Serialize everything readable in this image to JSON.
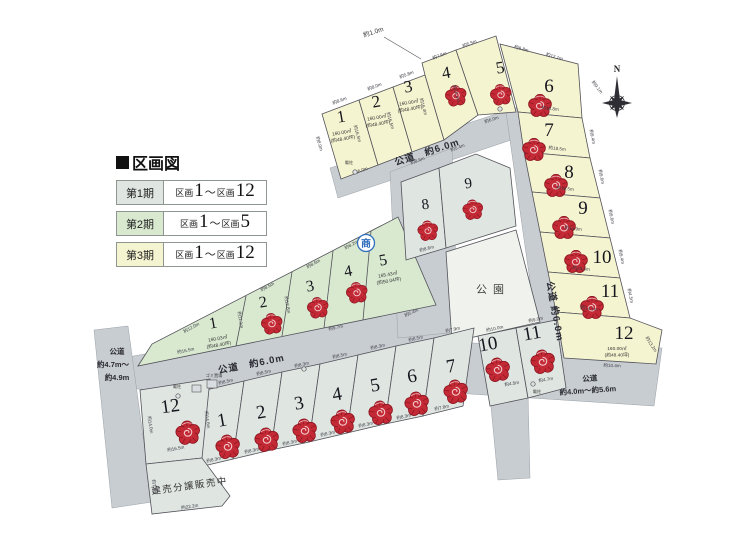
{
  "colors": {
    "phase1": "#dfe5e1",
    "phase2": "#d9e9d0",
    "phase3": "#f5f4d0",
    "road": "#c8cdd1",
    "park": "#f0f3ed",
    "stroke": "#52525a",
    "rose": "#c42a35",
    "roseDark": "#8e1722",
    "roseLight": "#f3cdd0",
    "accent": "#2f6fbe"
  },
  "legend": {
    "title": "区画図",
    "rows": [
      {
        "phase": "第1期",
        "prefix": "区画",
        "from": "1",
        "tilde": "～",
        "prefix2": "区画",
        "to": "12"
      },
      {
        "phase": "第2期",
        "prefix": "区画",
        "from": "1",
        "tilde": "～",
        "prefix2": "区画",
        "to": "5"
      },
      {
        "phase": "第3期",
        "prefix": "区画",
        "from": "1",
        "tilde": "～",
        "prefix2": "区画",
        "to": "12"
      }
    ]
  },
  "map": {
    "compass_label": "N",
    "sho_mark": "商",
    "park_label": "公園",
    "built_sale_label": "建売分譲販売中",
    "top_gap_label": "約1.0m",
    "markers": {
      "denchu": "電柱",
      "gomi": "ゴミ置場"
    },
    "road_labels": {
      "top": "公道　約6.0m",
      "right": "公道 約6.0m",
      "middle": "公道　約6.0m",
      "br_road": "公道",
      "br_width": "約4.0m～約5.6m",
      "left_road": "公道",
      "left_w1": "約4.7m～",
      "left_w2": "約4.9m"
    },
    "lot_groups": [
      {
        "phase": "第3期",
        "fs": 17,
        "rot": -10,
        "rose_size": 22,
        "lots": [
          {
            "n": "1",
            "x": 342,
            "y": 122,
            "area": [
              "160.00㎡",
              "(約48.40坪)"
            ],
            "ax": 342,
            "ay": 134
          },
          {
            "n": "2",
            "x": 377,
            "y": 107,
            "area": [
              "160.00㎡",
              "(約48.40坪)"
            ],
            "ax": 377,
            "ay": 119
          },
          {
            "n": "3",
            "x": 409,
            "y": 92,
            "area": [
              "160.00㎡",
              "(約48.40坪)"
            ],
            "ax": 409,
            "ay": 104
          },
          {
            "n": "4",
            "x": 447,
            "y": 78,
            "rx": 456,
            "ry": 96
          },
          {
            "n": "5",
            "x": 501,
            "y": 73,
            "rx": 501,
            "ry": 95
          }
        ]
      },
      {
        "phase": "第3期",
        "fs": 19,
        "rot": 0,
        "rose_size": 24,
        "lots": [
          {
            "n": "6",
            "x": 549,
            "y": 92,
            "rx": 540,
            "ry": 106
          },
          {
            "n": "7",
            "x": 549,
            "y": 136,
            "rx": 534,
            "ry": 150
          },
          {
            "n": "8",
            "x": 569,
            "y": 178,
            "rx": 556,
            "ry": 186
          },
          {
            "n": "9",
            "x": 583,
            "y": 214,
            "rx": 564,
            "ry": 228
          },
          {
            "n": "10",
            "x": 602,
            "y": 263,
            "rx": 576,
            "ry": 262
          },
          {
            "n": "11",
            "x": 610,
            "y": 297,
            "rx": 592,
            "ry": 308
          },
          {
            "n": "12",
            "x": 624,
            "y": 339,
            "area": [
              "160.00㎡",
              "(約48.40坪)"
            ],
            "ax": 617,
            "ay": 350
          }
        ]
      },
      {
        "phase": "第2期",
        "fs": 16,
        "rot": -10,
        "rose_size": 22,
        "lots": [
          {
            "n": "1",
            "x": 214,
            "y": 328,
            "area": [
              "160.03㎡",
              "(約48.40坪)"
            ],
            "ax": 218,
            "ay": 340
          },
          {
            "n": "2",
            "x": 264,
            "y": 307,
            "rx": 272,
            "ry": 324
          },
          {
            "n": "3",
            "x": 311,
            "y": 291,
            "rx": 318,
            "ry": 308
          },
          {
            "n": "4",
            "x": 349,
            "y": 276,
            "rx": 357,
            "ry": 293
          },
          {
            "n": "5",
            "x": 384,
            "y": 265,
            "area": [
              "165.43㎡",
              "(約50.04坪)"
            ],
            "ax": 388,
            "ay": 276
          }
        ]
      },
      {
        "phase": "第1期",
        "fs": 15,
        "rot": -8,
        "rose_size": 21,
        "lots": [
          {
            "n": "8",
            "x": 426,
            "y": 209,
            "rx": 428,
            "ry": 231
          },
          {
            "n": "9",
            "x": 469,
            "y": 188,
            "rx": 473,
            "ry": 210
          }
        ]
      },
      {
        "phase": "第1期",
        "fs": 19,
        "rot": -10,
        "rose_size": 25,
        "lots": [
          {
            "n": "1",
            "x": 223,
            "y": 426,
            "rx": 228,
            "ry": 447
          },
          {
            "n": "2",
            "x": 262,
            "y": 418,
            "rx": 267,
            "ry": 440
          },
          {
            "n": "3",
            "x": 300,
            "y": 409,
            "rx": 305,
            "ry": 431
          },
          {
            "n": "4",
            "x": 338,
            "y": 400,
            "rx": 343,
            "ry": 422
          },
          {
            "n": "5",
            "x": 376,
            "y": 391,
            "rx": 381,
            "ry": 413
          },
          {
            "n": "6",
            "x": 413,
            "y": 382,
            "rx": 417,
            "ry": 404
          },
          {
            "n": "7",
            "x": 452,
            "y": 372,
            "rx": 456,
            "ry": 392
          },
          {
            "n": "10",
            "x": 489,
            "y": 350,
            "rx": 498,
            "ry": 370
          },
          {
            "n": "11",
            "x": 533,
            "y": 339,
            "rx": 543,
            "ry": 362
          }
        ]
      },
      {
        "phase": "第1期",
        "fs": 19,
        "rot": -8,
        "rose_size": 25,
        "lots": [
          {
            "n": "12",
            "x": 171,
            "y": 412,
            "rx": 188,
            "ry": 433
          }
        ]
      }
    ],
    "dims": [
      {
        "t": "約8.6m",
        "x": 340,
        "y": 102,
        "r": -21
      },
      {
        "t": "約8.0m",
        "x": 375,
        "y": 88,
        "r": -21
      },
      {
        "t": "約5.8m",
        "x": 407,
        "y": 76,
        "r": -21
      },
      {
        "t": "約7.6m",
        "x": 440,
        "y": 57,
        "r": -21
      },
      {
        "t": "約5.5m",
        "x": 470,
        "y": 45,
        "r": -21
      },
      {
        "t": "約9.8m",
        "x": 521,
        "y": 50,
        "r": 16
      },
      {
        "t": "約12.1m",
        "x": 554,
        "y": 58,
        "r": 16
      },
      {
        "t": "約8.0m",
        "x": 318,
        "y": 144,
        "r": 74
      },
      {
        "t": "約16.5m",
        "x": 356,
        "y": 134,
        "r": 74
      },
      {
        "t": "約16.5m",
        "x": 389,
        "y": 121,
        "r": 74
      },
      {
        "t": "約16.4m",
        "x": 422,
        "y": 107,
        "r": 74
      },
      {
        "t": "約16.4m",
        "x": 455,
        "y": 94,
        "r": 74
      },
      {
        "t": "約6.0m",
        "x": 361,
        "y": 172,
        "r": -19
      },
      {
        "t": "約6.0m",
        "x": 492,
        "y": 121,
        "r": -19
      },
      {
        "t": "約9.1m",
        "x": 596,
        "y": 88,
        "r": 52
      },
      {
        "t": "約18.8m",
        "x": 550,
        "y": 110,
        "r": 6
      },
      {
        "t": "約9.4m",
        "x": 591,
        "y": 137,
        "r": 78
      },
      {
        "t": "約18.5m",
        "x": 557,
        "y": 150,
        "r": 6
      },
      {
        "t": "約9.6m",
        "x": 600,
        "y": 177,
        "r": 78
      },
      {
        "t": "約16.5m",
        "x": 565,
        "y": 190,
        "r": 6
      },
      {
        "t": "約9.6m",
        "x": 610,
        "y": 217,
        "r": 78
      },
      {
        "t": "約14.9m",
        "x": 573,
        "y": 230,
        "r": 6
      },
      {
        "t": "約9.4m",
        "x": 620,
        "y": 257,
        "r": 78
      },
      {
        "t": "約13.6m",
        "x": 581,
        "y": 270,
        "r": 6
      },
      {
        "t": "約4.5m",
        "x": 629,
        "y": 296,
        "r": 78
      },
      {
        "t": "約14.1m",
        "x": 589,
        "y": 310,
        "r": 6
      },
      {
        "t": "約13.2m",
        "x": 650,
        "y": 345,
        "r": 58
      },
      {
        "t": "約10.4m",
        "x": 612,
        "y": 367,
        "r": 2
      },
      {
        "t": "約12.0m",
        "x": 192,
        "y": 329,
        "r": -28
      },
      {
        "t": "約8.5m",
        "x": 268,
        "y": 288,
        "r": -28
      },
      {
        "t": "約8.6m",
        "x": 314,
        "y": 265,
        "r": -28
      },
      {
        "t": "約8.2m",
        "x": 352,
        "y": 246,
        "r": -28
      },
      {
        "t": "約11.1m",
        "x": 239,
        "y": 320,
        "r": 80
      },
      {
        "t": "約12.8m",
        "x": 286,
        "y": 305,
        "r": 80
      },
      {
        "t": "約16.5m",
        "x": 186,
        "y": 352,
        "r": -12
      },
      {
        "t": "約9.7m",
        "x": 336,
        "y": 329,
        "r": -12
      },
      {
        "t": "約5.4m",
        "x": 412,
        "y": 314,
        "r": -24
      },
      {
        "t": "約8.6m",
        "x": 418,
        "y": 162,
        "r": -20
      },
      {
        "t": "約5.4m",
        "x": 458,
        "y": 149,
        "r": -20
      },
      {
        "t": "約8.6m",
        "x": 427,
        "y": 250,
        "r": -15
      },
      {
        "t": "約8.5m",
        "x": 226,
        "y": 383,
        "r": -13
      },
      {
        "t": "約8.5m",
        "x": 264,
        "y": 374,
        "r": -13
      },
      {
        "t": "約8.3m",
        "x": 302,
        "y": 366,
        "r": -13
      },
      {
        "t": "約8.5m",
        "x": 340,
        "y": 357,
        "r": -13
      },
      {
        "t": "約8.3m",
        "x": 378,
        "y": 348,
        "r": -13
      },
      {
        "t": "約8.5m",
        "x": 416,
        "y": 340,
        "r": -13
      },
      {
        "t": "約7.9m",
        "x": 453,
        "y": 331,
        "r": -13
      },
      {
        "t": "約10.0m",
        "x": 495,
        "y": 330,
        "r": -12
      },
      {
        "t": "約9.0m",
        "x": 536,
        "y": 321,
        "r": -12
      },
      {
        "t": "約8.3m",
        "x": 214,
        "y": 461,
        "r": -13
      },
      {
        "t": "約8.3m",
        "x": 252,
        "y": 452,
        "r": -13
      },
      {
        "t": "約8.3m",
        "x": 290,
        "y": 444,
        "r": -13
      },
      {
        "t": "約8.3m",
        "x": 328,
        "y": 435,
        "r": -13
      },
      {
        "t": "約8.3m",
        "x": 366,
        "y": 426,
        "r": -13
      },
      {
        "t": "約8.3m",
        "x": 404,
        "y": 418,
        "r": -13
      },
      {
        "t": "約7.8m",
        "x": 442,
        "y": 409,
        "r": -13
      },
      {
        "t": "約4.5m",
        "x": 512,
        "y": 385,
        "r": -10
      },
      {
        "t": "約4.7m",
        "x": 546,
        "y": 381,
        "r": -10
      },
      {
        "t": "約14.6m",
        "x": 206,
        "y": 420,
        "r": 82
      },
      {
        "t": "約14.0m",
        "x": 149,
        "y": 425,
        "r": 82
      },
      {
        "t": "約16.5m",
        "x": 176,
        "y": 450,
        "r": -10
      },
      {
        "t": "約7.4m",
        "x": 153,
        "y": 487,
        "r": 82
      },
      {
        "t": "約22.2m",
        "x": 190,
        "y": 508,
        "r": -9
      }
    ]
  }
}
